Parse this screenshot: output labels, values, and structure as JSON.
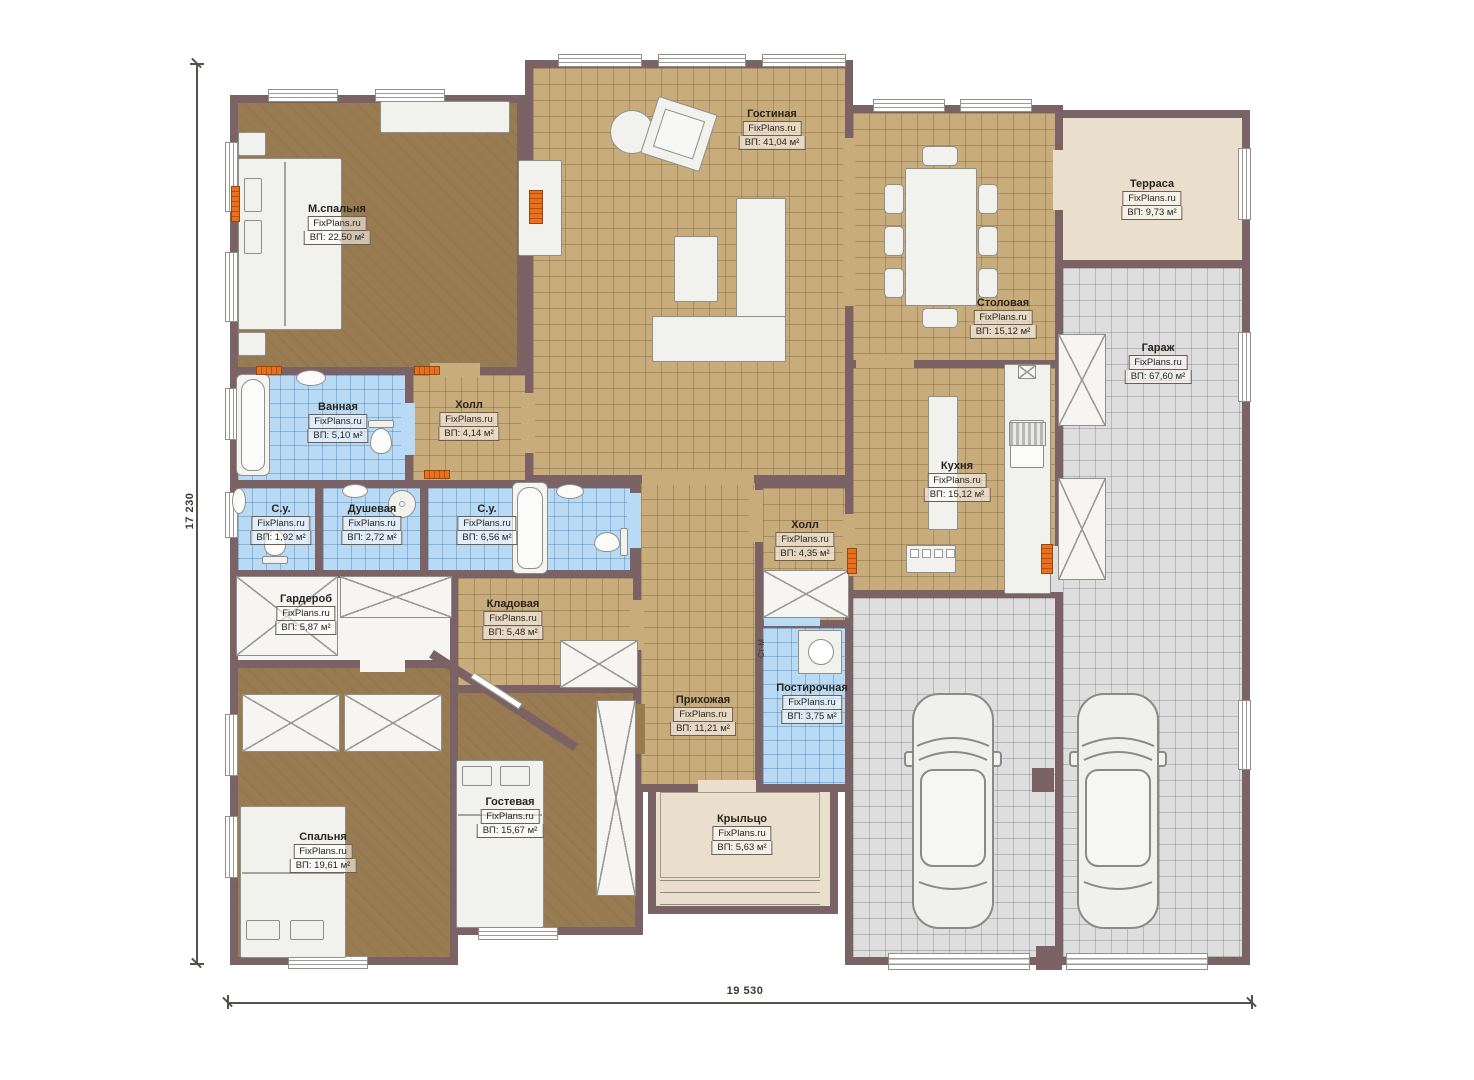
{
  "watermark": "FixPlans.ru",
  "dimensions": {
    "width_label": "19 530",
    "height_label": "17 230"
  },
  "laundry_machine_label": "Ст-М",
  "colors": {
    "wall": "#7b6264",
    "floor_wood": "#c9ac7b",
    "floor_bedroom": "#997b51",
    "floor_gray": "#dedede",
    "floor_blue": "#b9daf4",
    "floor_beige": "#eadfcc",
    "radiator": "#e8701e"
  },
  "rooms": [
    {
      "name": "Гостиная",
      "watermark": "FixPlans.ru",
      "area": "ВП: 41,04 м²"
    },
    {
      "name": "М.спальня",
      "watermark": "FixPlans.ru",
      "area": "ВП: 22,50 м²"
    },
    {
      "name": "Терраса",
      "watermark": "FixPlans.ru",
      "area": "ВП: 9,73 м²"
    },
    {
      "name": "Столовая",
      "watermark": "FixPlans.ru",
      "area": "ВП: 15,12 м²"
    },
    {
      "name": "Гараж",
      "watermark": "FixPlans.ru",
      "area": "ВП: 67,60 м²"
    },
    {
      "name": "Ванная",
      "watermark": "FixPlans.ru",
      "area": "ВП: 5,10 м²"
    },
    {
      "name": "Холл",
      "watermark": "FixPlans.ru",
      "area": "ВП: 4,14 м²"
    },
    {
      "name": "С.у.",
      "watermark": "FixPlans.ru",
      "area": "ВП: 1,92 м²"
    },
    {
      "name": "Душевая",
      "watermark": "FixPlans.ru",
      "area": "ВП: 2,72 м²"
    },
    {
      "name": "С.у.",
      "watermark": "FixPlans.ru",
      "area": "ВП: 6,56 м²"
    },
    {
      "name": "Кухня",
      "watermark": "FixPlans.ru",
      "area": "ВП: 15,12 м²"
    },
    {
      "name": "Холл",
      "watermark": "FixPlans.ru",
      "area": "ВП: 4,35 м²"
    },
    {
      "name": "Гардероб",
      "watermark": "FixPlans.ru",
      "area": "ВП: 5,87 м²"
    },
    {
      "name": "Кладовая",
      "watermark": "FixPlans.ru",
      "area": "ВП: 5,48 м²"
    },
    {
      "name": "Прихожая",
      "watermark": "FixPlans.ru",
      "area": "ВП: 11,21 м²"
    },
    {
      "name": "Постирочная",
      "watermark": "FixPlans.ru",
      "area": "ВП: 3,75 м²"
    },
    {
      "name": "Гостевая",
      "watermark": "FixPlans.ru",
      "area": "ВП: 15,67 м²"
    },
    {
      "name": "Спальня",
      "watermark": "FixPlans.ru",
      "area": "ВП: 19,61 м²"
    },
    {
      "name": "Крыльцо",
      "watermark": "FixPlans.ru",
      "area": "ВП: 5,63 м²"
    }
  ]
}
